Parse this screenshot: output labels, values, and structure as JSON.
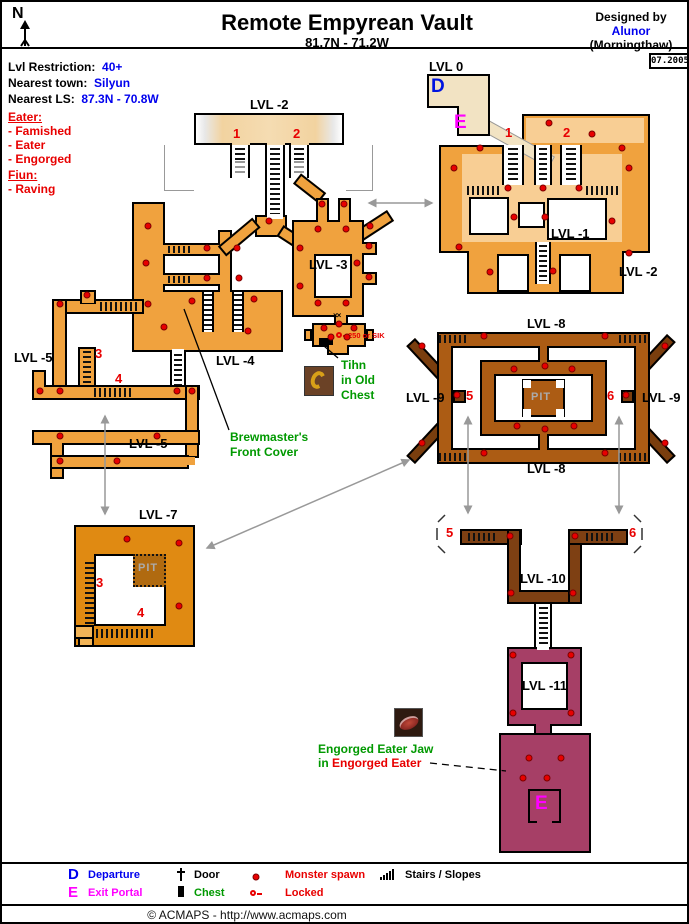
{
  "header": {
    "compass": "N",
    "title": "Remote Empyrean Vault",
    "coords": "81.7N - 71.2W",
    "designed_by_label": "Designed by",
    "designer": "Alunor",
    "server": "(Morningthaw)",
    "date_stamp": "07.2005"
  },
  "info_panel": {
    "lvl_restriction_label": "Lvl Restriction:",
    "lvl_restriction_value": "40+",
    "nearest_town_label": "Nearest town:",
    "nearest_town_value": "Silyun",
    "nearest_ls_label": "Nearest LS:",
    "nearest_ls_value": "87.3N - 70.8W",
    "monsters": [
      {
        "group": "Eater:",
        "entries": [
          "- Famished",
          "- Eater",
          "- Engorged"
        ]
      },
      {
        "group": "Fiun:",
        "entries": [
          "- Raving"
        ]
      }
    ]
  },
  "map": {
    "level_labels": [
      {
        "text": "LVL -2",
        "x": 248,
        "y": 95
      },
      {
        "text": "LVL 0",
        "x": 427,
        "y": 57
      },
      {
        "text": "LVL -1",
        "x": 549,
        "y": 224
      },
      {
        "text": "LVL -2",
        "x": 617,
        "y": 262
      },
      {
        "text": "LVL -3",
        "x": 307,
        "y": 255
      },
      {
        "text": "LVL -4",
        "x": 214,
        "y": 351
      },
      {
        "text": "LVL -5",
        "x": 12,
        "y": 348
      },
      {
        "text": "LVL -5",
        "x": 127,
        "y": 434
      },
      {
        "text": "LVL -7",
        "x": 137,
        "y": 505
      },
      {
        "text": "LVL -8",
        "x": 525,
        "y": 314
      },
      {
        "text": "LVL -8",
        "x": 525,
        "y": 459
      },
      {
        "text": "LVL -9",
        "x": 404,
        "y": 388
      },
      {
        "text": "LVL -9",
        "x": 640,
        "y": 388
      },
      {
        "text": "LVL -10",
        "x": 518,
        "y": 569
      },
      {
        "text": "LVL -11",
        "x": 520,
        "y": 676
      }
    ],
    "pit_labels": [
      {
        "text": "PIT",
        "x": 136,
        "y": 560
      },
      {
        "text": "PIT",
        "x": 529,
        "y": 389
      }
    ],
    "portal_markers": [
      {
        "text": "D",
        "x": 429,
        "y": 74,
        "color": "#0014E0"
      },
      {
        "text": "E",
        "x": 452,
        "y": 110,
        "color": "#FF00FF"
      },
      {
        "text": "E",
        "x": 533,
        "y": 791,
        "color": "#FF00FF"
      }
    ],
    "stair_numbers": [
      {
        "text": "1",
        "x": 231,
        "y": 124
      },
      {
        "text": "2",
        "x": 291,
        "y": 124
      },
      {
        "text": "1",
        "x": 503,
        "y": 123
      },
      {
        "text": "2",
        "x": 561,
        "y": 123
      },
      {
        "text": "3",
        "x": 93,
        "y": 344
      },
      {
        "text": "4",
        "x": 113,
        "y": 369
      },
      {
        "text": "3",
        "x": 94,
        "y": 573
      },
      {
        "text": "4",
        "x": 135,
        "y": 603
      },
      {
        "text": "5",
        "x": 464,
        "y": 386
      },
      {
        "text": "6",
        "x": 605,
        "y": 386
      },
      {
        "text": "5",
        "x": 444,
        "y": 523
      },
      {
        "text": "6",
        "x": 627,
        "y": 523
      }
    ],
    "annotations": {
      "brewmaster": [
        "Brewmaster's",
        "Front Cover"
      ],
      "tihn": [
        "Tihn",
        "in Old",
        "Chest"
      ],
      "lock_note": "250 or SIK",
      "eater_jaw_title": "Engorged Eater Jaw",
      "eater_jaw_in": "in",
      "eater_jaw_location": "Engorged Eater"
    },
    "spawn_points": [
      [
        547,
        121
      ],
      [
        590,
        132
      ],
      [
        478,
        146
      ],
      [
        620,
        146
      ],
      [
        452,
        166
      ],
      [
        627,
        166
      ],
      [
        506,
        186
      ],
      [
        541,
        186
      ],
      [
        577,
        186
      ],
      [
        512,
        215
      ],
      [
        543,
        215
      ],
      [
        610,
        219
      ],
      [
        457,
        245
      ],
      [
        627,
        251
      ],
      [
        488,
        270
      ],
      [
        551,
        269
      ],
      [
        146,
        224
      ],
      [
        144,
        261
      ],
      [
        146,
        302
      ],
      [
        205,
        246
      ],
      [
        235,
        246
      ],
      [
        205,
        276
      ],
      [
        237,
        276
      ],
      [
        267,
        219
      ],
      [
        190,
        299
      ],
      [
        252,
        297
      ],
      [
        162,
        325
      ],
      [
        246,
        329
      ],
      [
        368,
        224
      ],
      [
        298,
        246
      ],
      [
        298,
        284
      ],
      [
        316,
        227
      ],
      [
        344,
        227
      ],
      [
        355,
        261
      ],
      [
        316,
        301
      ],
      [
        344,
        301
      ],
      [
        320,
        202
      ],
      [
        342,
        202
      ],
      [
        367,
        244
      ],
      [
        367,
        275
      ],
      [
        322,
        326
      ],
      [
        337,
        322
      ],
      [
        352,
        326
      ],
      [
        329,
        335
      ],
      [
        345,
        335
      ],
      [
        58,
        302
      ],
      [
        85,
        293
      ],
      [
        38,
        389
      ],
      [
        58,
        389
      ],
      [
        175,
        389
      ],
      [
        190,
        389
      ],
      [
        58,
        434
      ],
      [
        155,
        434
      ],
      [
        58,
        459
      ],
      [
        115,
        459
      ],
      [
        125,
        537
      ],
      [
        177,
        541
      ],
      [
        177,
        604
      ],
      [
        420,
        344
      ],
      [
        663,
        344
      ],
      [
        420,
        441
      ],
      [
        663,
        441
      ],
      [
        482,
        334
      ],
      [
        603,
        334
      ],
      [
        482,
        451
      ],
      [
        603,
        451
      ],
      [
        512,
        367
      ],
      [
        570,
        367
      ],
      [
        543,
        364
      ],
      [
        515,
        424
      ],
      [
        543,
        427
      ],
      [
        572,
        424
      ],
      [
        455,
        393
      ],
      [
        624,
        393
      ],
      [
        508,
        534
      ],
      [
        573,
        534
      ],
      [
        509,
        591
      ],
      [
        571,
        591
      ],
      [
        511,
        653
      ],
      [
        569,
        653
      ],
      [
        511,
        711
      ],
      [
        569,
        711
      ],
      [
        527,
        756
      ],
      [
        559,
        756
      ],
      [
        521,
        776
      ],
      [
        545,
        776
      ]
    ],
    "colors": {
      "passage_orange": "#F0A23E",
      "passage_light": "#F8CE94",
      "surface_cream": "#F2E3C3",
      "lvl7_orange": "#E08A12",
      "lvl8_brown": "#AC5C14",
      "lvl9_dark_brown": "#7A3E0E",
      "lvl10_brown": "#7E4013",
      "lvl11_maroon": "#A63F66",
      "spawn_red": "#E80000",
      "annotation_green": "#009900",
      "departure_blue": "#0000EE",
      "exit_magenta": "#FF00FF"
    }
  },
  "legend": {
    "departure_key": "D",
    "departure": "Departure",
    "exit_key": "E",
    "exit": "Exit Portal",
    "door": "Door",
    "chest": "Chest",
    "monster": "Monster spawn",
    "locked": "Locked",
    "stairs": "Stairs / Slopes"
  },
  "footer": {
    "copyright": "© ACMAPS - http://www.acmaps.com"
  }
}
